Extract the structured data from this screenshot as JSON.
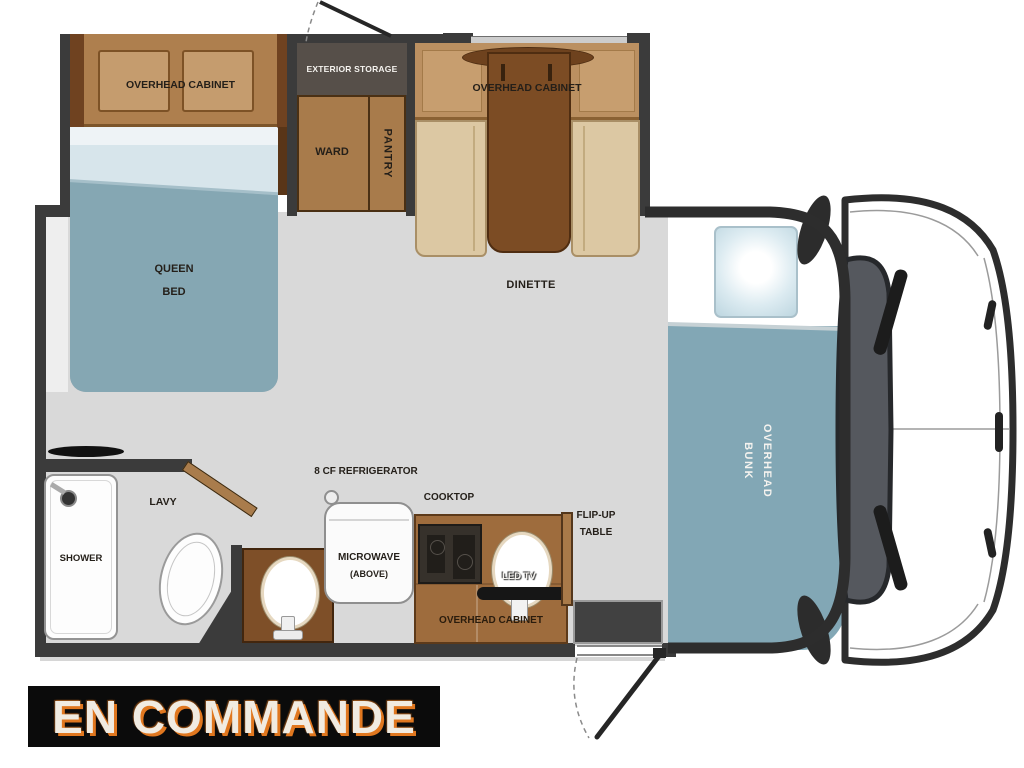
{
  "banner": {
    "text": "EN COMMANDE"
  },
  "labels": {
    "overhead_cabinet_bedroom": "OVERHEAD CABINET",
    "exterior_storage": "EXTERIOR STORAGE",
    "ward": "WARD",
    "pantry": "PANTRY",
    "overhead_cabinet_dinette": "OVERHEAD CABINET",
    "dinette": "DINETTE",
    "queen_bed_line1": "QUEEN",
    "queen_bed_line2": "BED",
    "overhead_bunk_line1": "OVERHEAD",
    "overhead_bunk_line2": "BUNK",
    "shower": "SHOWER",
    "lavy": "LAVY",
    "refrigerator": "8 CF REFRIGERATOR",
    "microwave_line1": "MICROWAVE",
    "microwave_line2": "(ABOVE)",
    "cooktop": "COOKTOP",
    "led_tv": "LED TV",
    "overhead_cabinet_kitchen": "OVERHEAD CABINET",
    "flip_up_line1": "FLIP-UP",
    "flip_up_line2": "TABLE"
  },
  "colors": {
    "wall": "#3b3b3b",
    "floor": "#d9d9d9",
    "cabinet_brown": "#ae7f4e",
    "dark_table_brown": "#7c4c24",
    "bench_beige": "#dcc8a3",
    "storage_gray": "#564f49",
    "bed_teal": "#85a7b3",
    "bunk_teal": "#82a7b5",
    "counter_brown": "#9e6c3d",
    "vanity_brown": "#7e4f28",
    "banner_bg": "#0b0b0b",
    "banner_text": "#f1ebe1",
    "banner_glow": "#e0771f"
  },
  "icons": {
    "roof_vent": "black-lens-bar",
    "shower_head": "dark-circle",
    "door_swing": "line-with-dashed-arc",
    "cab_front": "truck-cab-top-view"
  }
}
